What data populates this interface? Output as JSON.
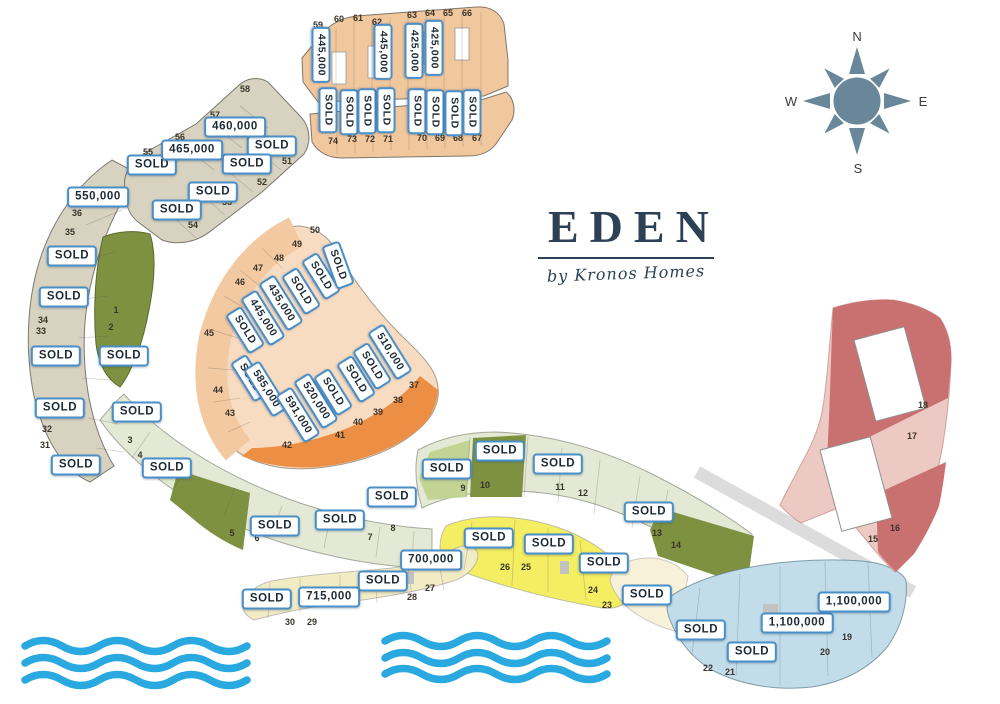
{
  "logo": {
    "name": "EDEN",
    "tagline": "by Kronos Homes"
  },
  "compass": {
    "north": "N",
    "east": "E",
    "south": "S",
    "west": "W"
  },
  "palette": {
    "label_border": "#4a8fc8",
    "label_text": "#1c2b36",
    "navy": "#2c4156",
    "wave_blue": "#29a9e0",
    "compass_slate": "#68889a",
    "beige": "#d8d2c1",
    "orange_row": "#f1c79e",
    "peach_light": "#f8dcc2",
    "peach_mid": "#f3c9a2",
    "orange_dark": "#ec8f45",
    "olive": "#7e9140",
    "sage": "#e3e9d4",
    "green_mid": "#c2d493",
    "yellow": "#f3ee62",
    "cream": "#f2ecc5",
    "cream_pale": "#f6f1d8",
    "blue": "#c2dde9",
    "pink_light": "#ecc9c3",
    "red_dark": "#c87170",
    "road_gray": "#dcdcdc"
  },
  "sections": [
    {
      "name": "hillside-crescent",
      "plots": "31-36",
      "color_key": "beige"
    },
    {
      "name": "north-terraces",
      "plots": "51-58",
      "color_key": "beige"
    },
    {
      "name": "north-rows",
      "plots": "59-74",
      "color_key": "orange_row"
    },
    {
      "name": "central-fan",
      "plots": "37-50",
      "color_key": "peach_light"
    },
    {
      "name": "garden-band-west",
      "plots": "1-8",
      "color_key": "sage"
    },
    {
      "name": "garden-band-east",
      "plots": "9-14",
      "color_key": "sage"
    },
    {
      "name": "beach-yellow",
      "plots": "23-26",
      "color_key": "yellow"
    },
    {
      "name": "beach-row",
      "plots": "27-30",
      "color_key": "cream"
    },
    {
      "name": "east-blue",
      "plots": "19-22",
      "color_key": "blue"
    },
    {
      "name": "east-villas",
      "plots": "15-18",
      "color_key": "pink_light"
    }
  ],
  "labels": [
    {
      "text": "SOLD",
      "x": 152,
      "y": 165,
      "rot": 0
    },
    {
      "text": "SOLD",
      "x": 272,
      "y": 146,
      "rot": 0
    },
    {
      "text": "SOLD",
      "x": 247,
      "y": 164,
      "rot": 0
    },
    {
      "text": "SOLD",
      "x": 213,
      "y": 192,
      "rot": 0
    },
    {
      "text": "SOLD",
      "x": 177,
      "y": 210,
      "rot": 0
    },
    {
      "text": "460,000",
      "x": 235,
      "y": 127,
      "rot": 0
    },
    {
      "text": "465,000",
      "x": 192,
      "y": 150,
      "rot": 0
    },
    {
      "text": "550,000",
      "x": 98,
      "y": 197,
      "rot": 0
    },
    {
      "text": "SOLD",
      "x": 72,
      "y": 256,
      "rot": 0
    },
    {
      "text": "SOLD",
      "x": 64,
      "y": 297,
      "rot": 0
    },
    {
      "text": "SOLD",
      "x": 56,
      "y": 356,
      "rot": 0
    },
    {
      "text": "SOLD",
      "x": 60,
      "y": 408,
      "rot": 0
    },
    {
      "text": "SOLD",
      "x": 76,
      "y": 465,
      "rot": 0
    },
    {
      "text": "SOLD",
      "x": 124,
      "y": 356,
      "rot": 0
    },
    {
      "text": "SOLD",
      "x": 137,
      "y": 412,
      "rot": 0
    },
    {
      "text": "SOLD",
      "x": 167,
      "y": 468,
      "rot": 0
    },
    {
      "text": "SOLD",
      "x": 275,
      "y": 526,
      "rot": 0
    },
    {
      "text": "SOLD",
      "x": 340,
      "y": 520,
      "rot": 0
    },
    {
      "text": "SOLD",
      "x": 392,
      "y": 497,
      "rot": 0
    },
    {
      "text": "SOLD",
      "x": 447,
      "y": 469,
      "rot": 0
    },
    {
      "text": "SOLD",
      "x": 500,
      "y": 451,
      "rot": 0
    },
    {
      "text": "SOLD",
      "x": 558,
      "y": 464,
      "rot": 0
    },
    {
      "text": "SOLD",
      "x": 649,
      "y": 512,
      "rot": 0
    },
    {
      "text": "SOLD",
      "x": 489,
      "y": 538,
      "rot": 0
    },
    {
      "text": "SOLD",
      "x": 549,
      "y": 544,
      "rot": 0
    },
    {
      "text": "700,000",
      "x": 431,
      "y": 560,
      "rot": 0
    },
    {
      "text": "SOLD",
      "x": 604,
      "y": 563,
      "rot": 0
    },
    {
      "text": "SOLD",
      "x": 647,
      "y": 595,
      "rot": 0
    },
    {
      "text": "SOLD",
      "x": 267,
      "y": 599,
      "rot": 0
    },
    {
      "text": "715,000",
      "x": 329,
      "y": 597,
      "rot": 0
    },
    {
      "text": "SOLD",
      "x": 383,
      "y": 581,
      "rot": 0
    },
    {
      "text": "SOLD",
      "x": 701,
      "y": 630,
      "rot": 0
    },
    {
      "text": "SOLD",
      "x": 752,
      "y": 652,
      "rot": 0
    },
    {
      "text": "1,100,000",
      "x": 797,
      "y": 623,
      "rot": 0
    },
    {
      "text": "1,100,000",
      "x": 854,
      "y": 602,
      "rot": 0
    },
    {
      "text": "445,000",
      "x": 321,
      "y": 55,
      "rot": 90
    },
    {
      "text": "445,000",
      "x": 383,
      "y": 52,
      "rot": 90
    },
    {
      "text": "425,000",
      "x": 414,
      "y": 51,
      "rot": 90
    },
    {
      "text": "425,000",
      "x": 434,
      "y": 48,
      "rot": 90
    },
    {
      "text": "SOLD",
      "x": 328,
      "y": 110,
      "rot": 90
    },
    {
      "text": "SOLD",
      "x": 349,
      "y": 112,
      "rot": 90
    },
    {
      "text": "SOLD",
      "x": 367,
      "y": 111,
      "rot": 90
    },
    {
      "text": "SOLD",
      "x": 386,
      "y": 110,
      "rot": 90
    },
    {
      "text": "SOLD",
      "x": 417,
      "y": 111,
      "rot": 90
    },
    {
      "text": "SOLD",
      "x": 435,
      "y": 112,
      "rot": 90
    },
    {
      "text": "SOLD",
      "x": 454,
      "y": 113,
      "rot": 90
    },
    {
      "text": "SOLD",
      "x": 472,
      "y": 112,
      "rot": 90
    },
    {
      "text": "SOLD",
      "x": 245,
      "y": 330,
      "rot": 58
    },
    {
      "text": "445,000",
      "x": 263,
      "y": 318,
      "rot": 58
    },
    {
      "text": "435,000",
      "x": 281,
      "y": 303,
      "rot": 58
    },
    {
      "text": "SOLD",
      "x": 301,
      "y": 291,
      "rot": 58
    },
    {
      "text": "SOLD",
      "x": 321,
      "y": 276,
      "rot": 58
    },
    {
      "text": "SOLD",
      "x": 338,
      "y": 265,
      "rot": 70
    },
    {
      "text": "SOLD",
      "x": 250,
      "y": 378,
      "rot": 58
    },
    {
      "text": "585,000",
      "x": 266,
      "y": 389,
      "rot": 58
    },
    {
      "text": "591,000",
      "x": 298,
      "y": 415,
      "rot": 58
    },
    {
      "text": "520,000",
      "x": 316,
      "y": 401,
      "rot": 58
    },
    {
      "text": "SOLD",
      "x": 333,
      "y": 392,
      "rot": 58
    },
    {
      "text": "SOLD",
      "x": 356,
      "y": 379,
      "rot": 58
    },
    {
      "text": "SOLD",
      "x": 372,
      "y": 366,
      "rot": 58
    },
    {
      "text": "510,000",
      "x": 390,
      "y": 352,
      "rot": 58
    }
  ],
  "plot_numbers": [
    {
      "n": "1",
      "x": 116,
      "y": 310
    },
    {
      "n": "2",
      "x": 111,
      "y": 327
    },
    {
      "n": "3",
      "x": 130,
      "y": 440
    },
    {
      "n": "4",
      "x": 140,
      "y": 455
    },
    {
      "n": "5",
      "x": 232,
      "y": 533
    },
    {
      "n": "6",
      "x": 257,
      "y": 538
    },
    {
      "n": "7",
      "x": 370,
      "y": 537
    },
    {
      "n": "8",
      "x": 393,
      "y": 528
    },
    {
      "n": "9",
      "x": 463,
      "y": 488
    },
    {
      "n": "10",
      "x": 485,
      "y": 485
    },
    {
      "n": "11",
      "x": 560,
      "y": 487
    },
    {
      "n": "12",
      "x": 583,
      "y": 493
    },
    {
      "n": "13",
      "x": 657,
      "y": 533
    },
    {
      "n": "14",
      "x": 676,
      "y": 545
    },
    {
      "n": "15",
      "x": 873,
      "y": 539
    },
    {
      "n": "16",
      "x": 895,
      "y": 528
    },
    {
      "n": "17",
      "x": 912,
      "y": 436
    },
    {
      "n": "18",
      "x": 923,
      "y": 405
    },
    {
      "n": "19",
      "x": 847,
      "y": 637
    },
    {
      "n": "20",
      "x": 825,
      "y": 652
    },
    {
      "n": "21",
      "x": 730,
      "y": 672
    },
    {
      "n": "22",
      "x": 708,
      "y": 668
    },
    {
      "n": "23",
      "x": 607,
      "y": 605
    },
    {
      "n": "24",
      "x": 593,
      "y": 590
    },
    {
      "n": "25",
      "x": 526,
      "y": 567
    },
    {
      "n": "26",
      "x": 505,
      "y": 567
    },
    {
      "n": "27",
      "x": 430,
      "y": 588
    },
    {
      "n": "28",
      "x": 412,
      "y": 597
    },
    {
      "n": "29",
      "x": 312,
      "y": 622
    },
    {
      "n": "30",
      "x": 290,
      "y": 622
    },
    {
      "n": "31",
      "x": 45,
      "y": 445
    },
    {
      "n": "32",
      "x": 47,
      "y": 429
    },
    {
      "n": "33",
      "x": 41,
      "y": 331
    },
    {
      "n": "34",
      "x": 43,
      "y": 320
    },
    {
      "n": "35",
      "x": 70,
      "y": 232
    },
    {
      "n": "36",
      "x": 77,
      "y": 213
    },
    {
      "n": "37",
      "x": 414,
      "y": 385
    },
    {
      "n": "38",
      "x": 398,
      "y": 400
    },
    {
      "n": "39",
      "x": 378,
      "y": 412
    },
    {
      "n": "40",
      "x": 358,
      "y": 422
    },
    {
      "n": "41",
      "x": 340,
      "y": 435
    },
    {
      "n": "42",
      "x": 287,
      "y": 445
    },
    {
      "n": "43",
      "x": 230,
      "y": 413
    },
    {
      "n": "44",
      "x": 218,
      "y": 390
    },
    {
      "n": "45",
      "x": 209,
      "y": 333
    },
    {
      "n": "46",
      "x": 240,
      "y": 282
    },
    {
      "n": "47",
      "x": 258,
      "y": 268
    },
    {
      "n": "48",
      "x": 279,
      "y": 258
    },
    {
      "n": "49",
      "x": 297,
      "y": 244
    },
    {
      "n": "50",
      "x": 315,
      "y": 230
    },
    {
      "n": "51",
      "x": 287,
      "y": 161
    },
    {
      "n": "52",
      "x": 262,
      "y": 182
    },
    {
      "n": "53",
      "x": 227,
      "y": 202
    },
    {
      "n": "54",
      "x": 193,
      "y": 225
    },
    {
      "n": "55",
      "x": 148,
      "y": 152
    },
    {
      "n": "56",
      "x": 180,
      "y": 137
    },
    {
      "n": "57",
      "x": 215,
      "y": 115
    },
    {
      "n": "58",
      "x": 245,
      "y": 89
    },
    {
      "n": "59",
      "x": 318,
      "y": 25
    },
    {
      "n": "60",
      "x": 339,
      "y": 19
    },
    {
      "n": "61",
      "x": 358,
      "y": 18
    },
    {
      "n": "62",
      "x": 377,
      "y": 22
    },
    {
      "n": "63",
      "x": 412,
      "y": 15
    },
    {
      "n": "64",
      "x": 430,
      "y": 13
    },
    {
      "n": "65",
      "x": 448,
      "y": 13
    },
    {
      "n": "66",
      "x": 467,
      "y": 13
    },
    {
      "n": "67",
      "x": 477,
      "y": 138
    },
    {
      "n": "68",
      "x": 458,
      "y": 138
    },
    {
      "n": "69",
      "x": 440,
      "y": 138
    },
    {
      "n": "70",
      "x": 422,
      "y": 138
    },
    {
      "n": "71",
      "x": 388,
      "y": 139
    },
    {
      "n": "72",
      "x": 370,
      "y": 139
    },
    {
      "n": "73",
      "x": 352,
      "y": 139
    },
    {
      "n": "74",
      "x": 333,
      "y": 141
    }
  ]
}
